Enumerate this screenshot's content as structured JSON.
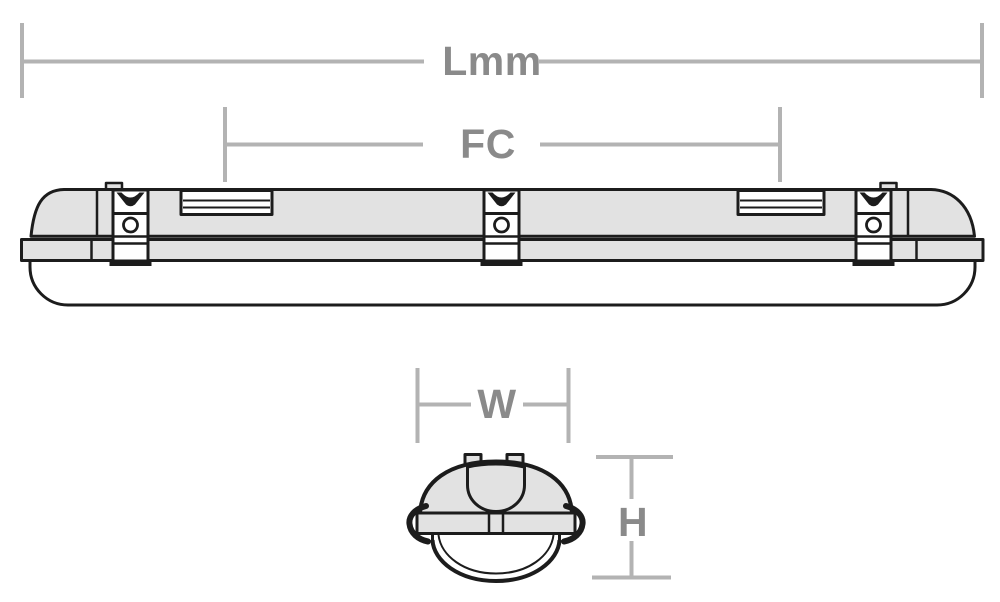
{
  "labels": {
    "length": "Lmm",
    "fixing_centres": "FC",
    "width": "W",
    "height": "H"
  },
  "colors": {
    "outline": "#1c1c1c",
    "body_fill": "#e2e2e2",
    "dimension_line": "#b3b3b3",
    "dimension_text": "#8a8a8a",
    "background": "#ffffff"
  }
}
